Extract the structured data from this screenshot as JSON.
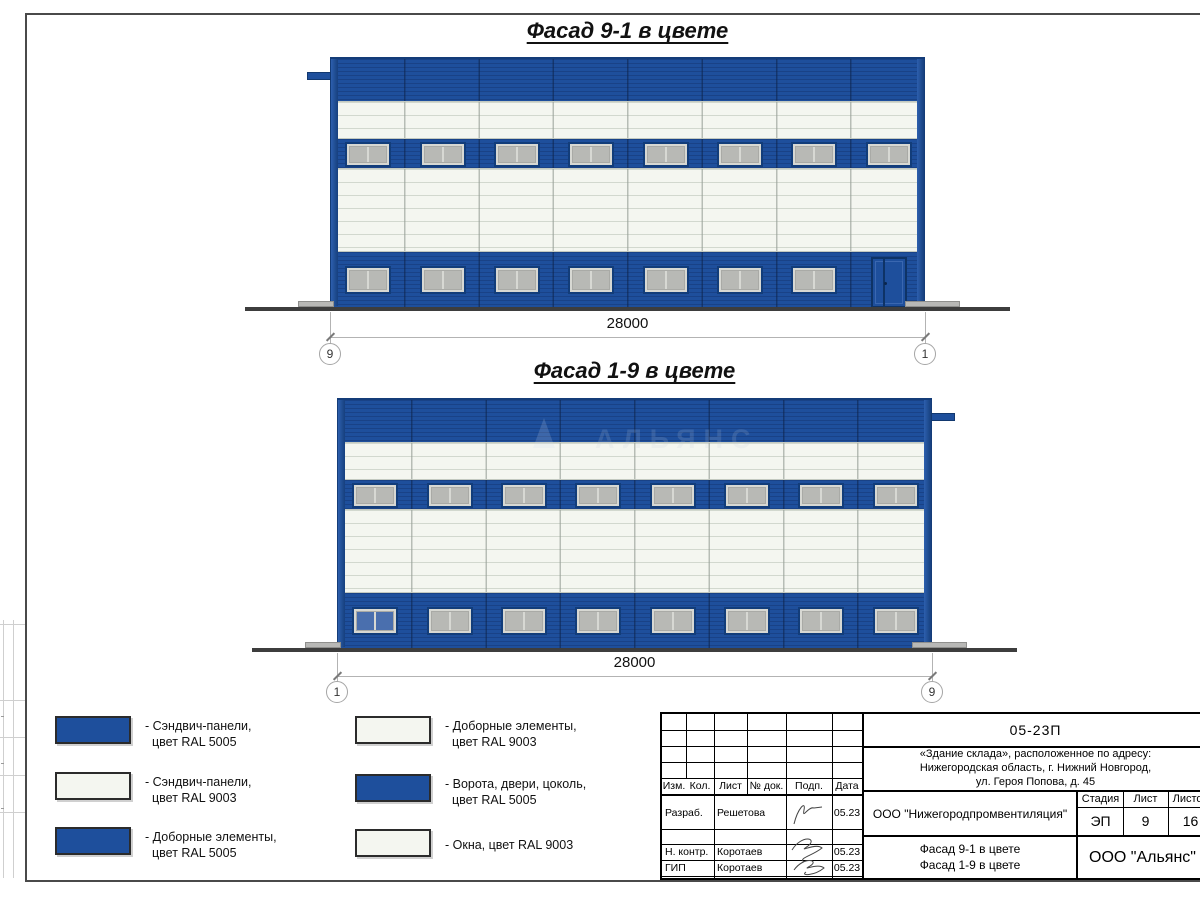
{
  "colors": {
    "ral5005_blue": "#1e4f9c",
    "ral9003_white": "#f4f6f0",
    "window_glass": "#b8b9b5",
    "window_frame": "#d7d8d3",
    "ground": "#3d3d3d"
  },
  "facades": [
    {
      "title": "Фасад 9-1 в цвете",
      "dimension": "28000",
      "axis_left": "9",
      "axis_right": "1",
      "bays": 8,
      "upper_windows": 8,
      "lower_windows": 7,
      "has_door": true,
      "first_lower_window_blue": false,
      "tab_side": "left",
      "watermark": ""
    },
    {
      "title": "Фасад 1-9 в цвете",
      "dimension": "28000",
      "axis_left": "1",
      "axis_right": "9",
      "bays": 8,
      "upper_windows": 8,
      "lower_windows": 8,
      "has_door": false,
      "first_lower_window_blue": true,
      "tab_side": "right",
      "watermark": "АЛЬЯНС"
    }
  ],
  "legend": [
    {
      "color": "blue",
      "line1": "- Сэндвич-панели,",
      "line2": "цвет RAL 5005"
    },
    {
      "color": "white",
      "line1": "- Сэндвич-панели,",
      "line2": "цвет RAL 9003"
    },
    {
      "color": "blue",
      "line1": "- Доборные элементы,",
      "line2": "цвет RAL 5005"
    },
    {
      "color": "white",
      "line1": "- Доборные элементы,",
      "line2": "цвет RAL 9003"
    },
    {
      "color": "blue",
      "line1": "- Ворота, двери, цоколь,",
      "line2": "цвет RAL 5005"
    },
    {
      "color": "white",
      "line1": "- Окна, цвет RAL 9003",
      "line2": ""
    }
  ],
  "title_block": {
    "doc_number": "05-23П",
    "object_address_line1": "«Здание склада», расположенное по адресу:",
    "object_address_line2": "Нижегородская область, г. Нижний Новгород,",
    "object_address_line3": "ул. Героя Попова, д. 45",
    "columns": {
      "izm": "Изм.",
      "kol": "Кол.",
      "list": "Лист",
      "doc": "№ док.",
      "podp": "Подп.",
      "data": "Дата"
    },
    "roles": [
      {
        "role": "Разраб.",
        "name": "Решетова",
        "date": "05.23"
      },
      {
        "role": "Н. контр.",
        "name": "Коротаев",
        "date": "05.23"
      },
      {
        "role": "ГИП",
        "name": "Коротаев",
        "date": "05.23"
      }
    ],
    "contractor": "ООО \"Нижегородпромвентиляция\"",
    "stage_label": "Стадия",
    "sheet_label": "Лист",
    "sheets_label": "Листов",
    "stage": "ЭП",
    "sheet": "9",
    "sheets": "16",
    "drawing_title_line1": "Фасад 9-1 в цвете",
    "drawing_title_line2": "Фасад 1-9 в цвете",
    "organization": "ООО \"Альянс\""
  }
}
